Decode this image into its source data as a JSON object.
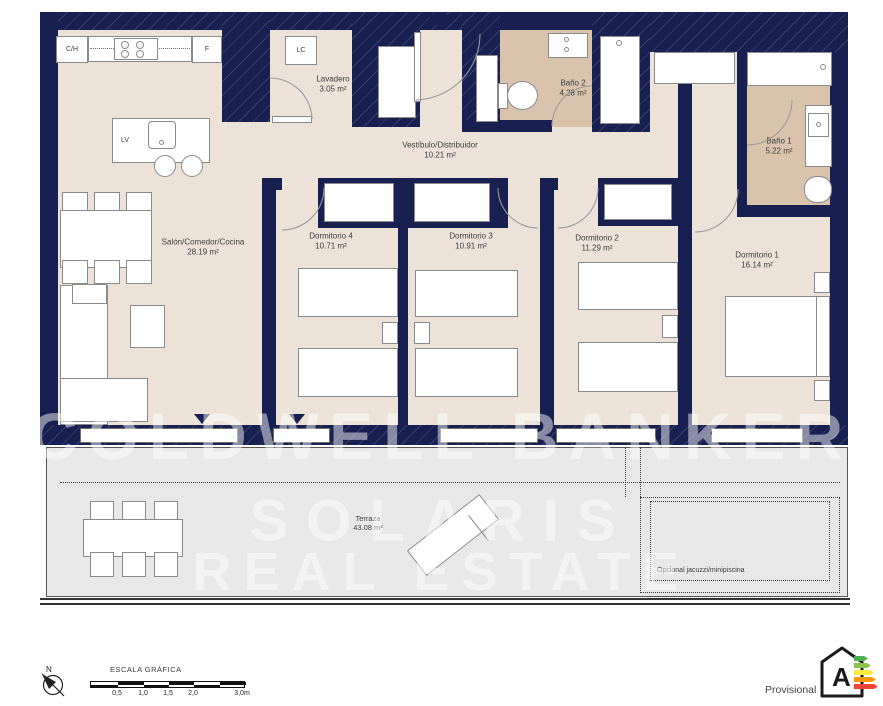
{
  "plan": {
    "type": "apartment-floor-plan",
    "rooms": [
      {
        "name": "Salón/Comedor/Cocina",
        "area": "28.19 m²"
      },
      {
        "name": "Lavadero",
        "area": "3.05 m²"
      },
      {
        "name": "Vestíbulo/Distribuidor",
        "area": "10.21 m²"
      },
      {
        "name": "Baño 2",
        "area": "4.28 m²"
      },
      {
        "name": "Baño 1",
        "area": "5.22 m²"
      },
      {
        "name": "Dormitorio 4",
        "area": "10.71 m²"
      },
      {
        "name": "Dormitorio 3",
        "area": "10.91 m²"
      },
      {
        "name": "Dormitorio 2",
        "area": "11.29 m²"
      },
      {
        "name": "Dormitorio 1",
        "area": "16.14 m²"
      },
      {
        "name": "Terraza",
        "area": "43.08 m²"
      }
    ],
    "annotations": {
      "jacuzzi_note": "Opcional jacuzzi/minipiscina"
    },
    "fixtures": {
      "ch": "C/H",
      "fridge": "F",
      "laundry_closet": "LC",
      "dishwasher": "LV"
    }
  },
  "watermark": {
    "lines": [
      "COLDWELL BANKER",
      "SOLARIS",
      "REAL ESTATE"
    ]
  },
  "scale_bar": {
    "title": "ESCALA GRÁFICA",
    "labels": [
      "0,5",
      "1,0",
      "1,5",
      "2,0",
      "3,0m"
    ]
  },
  "compass": {
    "label": "N"
  },
  "energy_label": {
    "status": "Provisional",
    "rating": "A",
    "arrow_colors": [
      "#4caf50",
      "#8bc34a",
      "#ffe93b",
      "#ff9800",
      "#f44336"
    ]
  },
  "colors": {
    "wall": "#172050",
    "floor": "#ede2d7",
    "bath_floor": "#d9c3ad",
    "terrace_floor": "#e8e8e8"
  }
}
